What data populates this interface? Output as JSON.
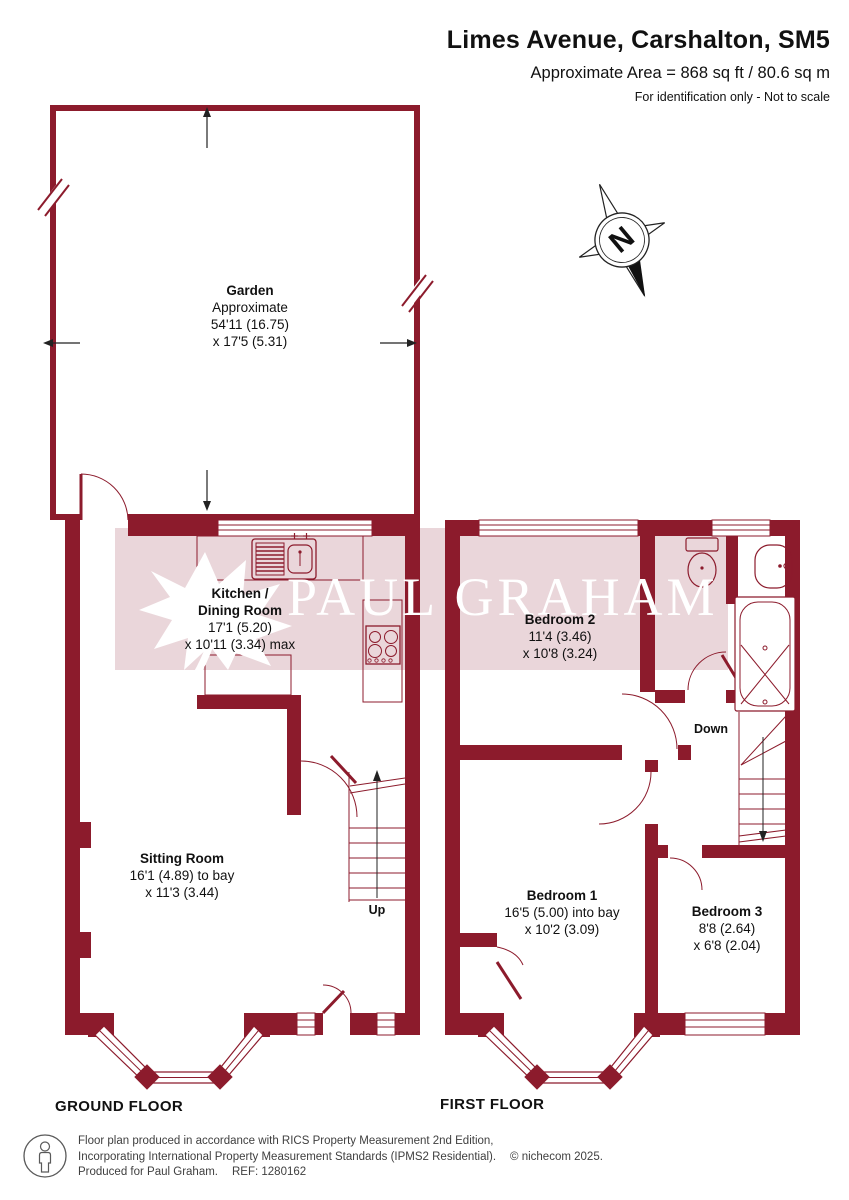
{
  "header": {
    "title": "Limes Avenue, Carshalton, SM5",
    "area": "Approximate Area = 868 sq ft / 80.6 sq m",
    "note": "For identification only - Not to scale"
  },
  "compass": {
    "n": "N"
  },
  "watermark": {
    "text": "PAUL GRAHAM"
  },
  "floors": {
    "ground": {
      "label": "GROUND FLOOR"
    },
    "first": {
      "label": "FIRST FLOOR"
    }
  },
  "rooms": {
    "garden": {
      "name": "Garden",
      "dims": "Approximate\n54'11 (16.75)\nx 17'5 (5.31)"
    },
    "kitchen": {
      "name": "Kitchen /\nDining Room",
      "dims": "17'1 (5.20)\nx 10'11 (3.34) max"
    },
    "sitting": {
      "name": "Sitting Room",
      "dims": "16'1 (4.89) to bay\nx 11'3 (3.44)"
    },
    "bedroom2": {
      "name": "Bedroom 2",
      "dims": "11'4 (3.46)\nx 10'8 (3.24)"
    },
    "bedroom1": {
      "name": "Bedroom 1",
      "dims": "16'5 (5.00) into bay\nx 10'2 (3.09)"
    },
    "bedroom3": {
      "name": "Bedroom 3",
      "dims": "8'8 (2.64)\nx 6'8 (2.04)"
    }
  },
  "stairs": {
    "up": "Up",
    "down": "Down"
  },
  "footer": {
    "line1": "Floor plan produced in accordance with RICS Property Measurement 2nd Edition,",
    "line2": "Incorporating International Property Measurement Standards (IPMS2 Residential).",
    "copyright": "© nichecom 2025.",
    "line3": "Produced for Paul Graham.",
    "ref": "REF: 1280162"
  },
  "colors": {
    "wall": "#8c1b2c",
    "band": "#ead6da"
  }
}
